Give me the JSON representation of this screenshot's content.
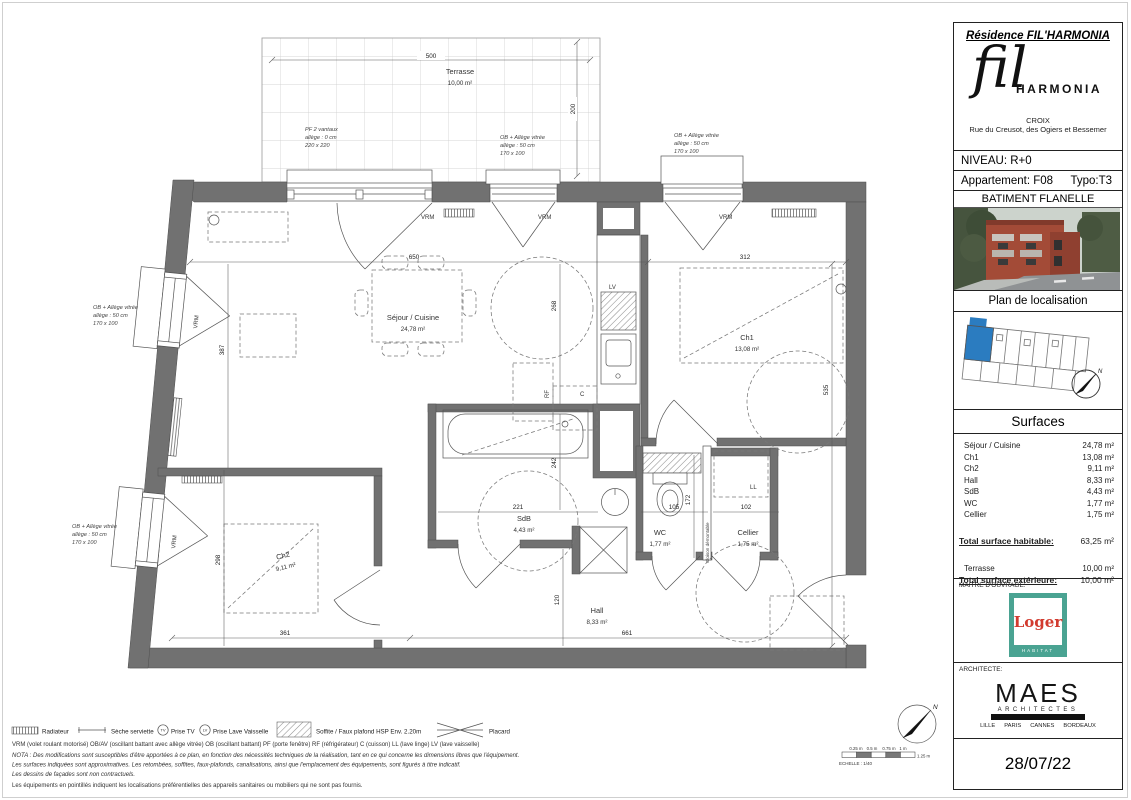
{
  "header": {
    "residence_title": "Résidence FIL'HARMONIA",
    "logo_fil": "fil",
    "logo_harmonia": "HARMONIA",
    "city": "CROIX",
    "address": "Rue du Creusot, des Ogiers et Bessemer",
    "niveau": "NIVEAU: R+0",
    "appartement": "Appartement: F08",
    "typo": "Typo:T3",
    "batiment": "BATIMENT FLANELLE",
    "plan_loc": "Plan de localisation"
  },
  "surfaces": {
    "title": "Surfaces",
    "rows": [
      {
        "label": "Séjour / Cuisine",
        "value": "24,78 m²"
      },
      {
        "label": "Ch1",
        "value": "13,08 m²"
      },
      {
        "label": "Ch2",
        "value": "9,11 m²"
      },
      {
        "label": "Hall",
        "value": "8,33 m²"
      },
      {
        "label": "SdB",
        "value": "4,43 m²"
      },
      {
        "label": "WC",
        "value": "1,77 m²"
      },
      {
        "label": "Cellier",
        "value": "1,75 m²"
      }
    ],
    "total_hab_label": "Total surface habitable:",
    "total_hab_value": "63,25 m²",
    "terrasse_label": "Terrasse",
    "terrasse_value": "10,00 m²",
    "total_ext_label": "Total surface extérieure:",
    "total_ext_value": "10,00 m²"
  },
  "stakeholders": {
    "maitre_label": "MAITRE D'OUVRAGE:",
    "architecte_label": "ARCHITECTE:",
    "loger_name": "Loger",
    "loger_sub": "HABITAT",
    "maes_name": "MAES",
    "maes_sub": "ARCHITECTES",
    "cities": [
      "LILLE",
      "PARIS",
      "CANNES",
      "BORDEAUX"
    ],
    "date": "28/07/22"
  },
  "plan": {
    "rooms": {
      "terrasse": {
        "name": "Terrasse",
        "area": "10,00 m²"
      },
      "sejour": {
        "name": "Séjour / Cuisine",
        "area": "24,78 m²"
      },
      "ch1": {
        "name": "Ch1",
        "area": "13,08 m²"
      },
      "ch2": {
        "name": "Ch2",
        "area": "9,11 m²"
      },
      "sdb": {
        "name": "SdB",
        "area": "4,43 m²"
      },
      "wc": {
        "name": "WC",
        "area": "1,77 m²"
      },
      "cellier": {
        "name": "Cellier",
        "area": "1,75 m²"
      },
      "hall": {
        "name": "Hall",
        "area": "8,33 m²"
      }
    },
    "dims": {
      "d500": "500",
      "d200": "200",
      "d650": "650",
      "d312": "312",
      "d268": "268",
      "d535": "535",
      "d387": "387",
      "d298": "298",
      "d242": "242",
      "d221": "221",
      "d105": "105",
      "d172": "172",
      "d102": "102",
      "d120": "120",
      "d661": "661",
      "d361": "361"
    },
    "windows": {
      "pf1": "PF 2 vantaux",
      "pf2": "allège : 0 cm",
      "pf3": "220 x 220",
      "ob1": "OB + Allège vitrée",
      "ob2": "allège : 50 cm",
      "ob3": "170 x 100"
    },
    "tags": {
      "vrm": "VRM",
      "lv": "LV",
      "rf": "RF",
      "c": "C",
      "ll": "LL",
      "cloison": "Cloison démontable",
      "north": "N"
    }
  },
  "legend": {
    "radiateur": "Radiateur",
    "seche": "Sèche serviette",
    "prise_tv": "Prise TV",
    "prise_lv": "Prise Lave Vaisselle",
    "tv_abbr": "TV",
    "lv_abbr": "LV",
    "soffite": "Soffite / Faux plafond HSP Env. 2.20m",
    "placard": "Placard",
    "abbrev": "VRM (volet roulant motorisé) OB/AV (oscillant battant avec allège vitrée) OB (oscillant battant) PF (porte fenêtre) RF (réfrigérateur) C (cuisson) LL (lave linge) LV (lave vaisselle)",
    "nota": "NOTA : Des modifications sont susceptibles d'être apportées à ce plan, en fonction des nécessités techniques de la réalisation, tant en ce qui concerne les dimensions libres que l'équipement.",
    "note2": "Les surfaces indiquées sont approximatives. Les retombées, soffites, faux-plafonds, canalisations, ainsi que l'emplacement des équipements, sont figurés à titre indicatif.",
    "note3": "Les dessins de façades sont non contractuels.",
    "note4": "Les équipements en pointillés indiquent les localisations préférentielles des appareils sanitaires ou mobiliers qui ne sont pas fournis."
  },
  "scalebar": {
    "t1": "0.25 m",
    "t2": "0.5 m",
    "t3": "0.75 m",
    "t4": "1 m",
    "t5": "1.25 m",
    "echelle": "ECHELLE : 1/40"
  },
  "colors": {
    "accent_blue": "#2b7cc0",
    "wall_gray": "#717171",
    "loger_teal": "#4aa392",
    "loger_red": "#d23b2f"
  }
}
